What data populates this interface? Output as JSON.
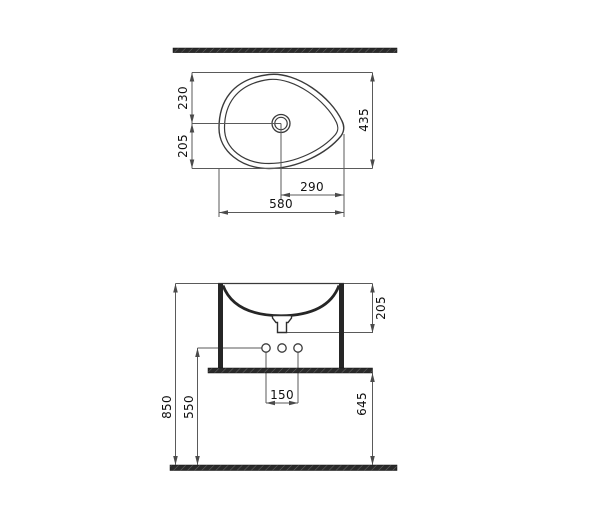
{
  "drawing": {
    "views": [
      "top-view",
      "front-view"
    ]
  },
  "top_view": {
    "dims": {
      "overall_width": "580",
      "overall_depth": "435",
      "drain_center_from_back": "230",
      "drain_center_from_front": "205",
      "drain_center_to_right_edge": "290"
    }
  },
  "front_view": {
    "dims": {
      "overall_height": "850",
      "faucet_holes_height": "550",
      "worktop_underside_height": "645",
      "rim_to_outlet_depth": "205",
      "faucet_holes_spacing": "150"
    }
  },
  "colors": {
    "background": "#ffffff",
    "drawing_line": "#3a3a3a",
    "dimension_line": "#5a5a5a",
    "label_text": "#111111",
    "solid_section": "#2a2a2a"
  }
}
